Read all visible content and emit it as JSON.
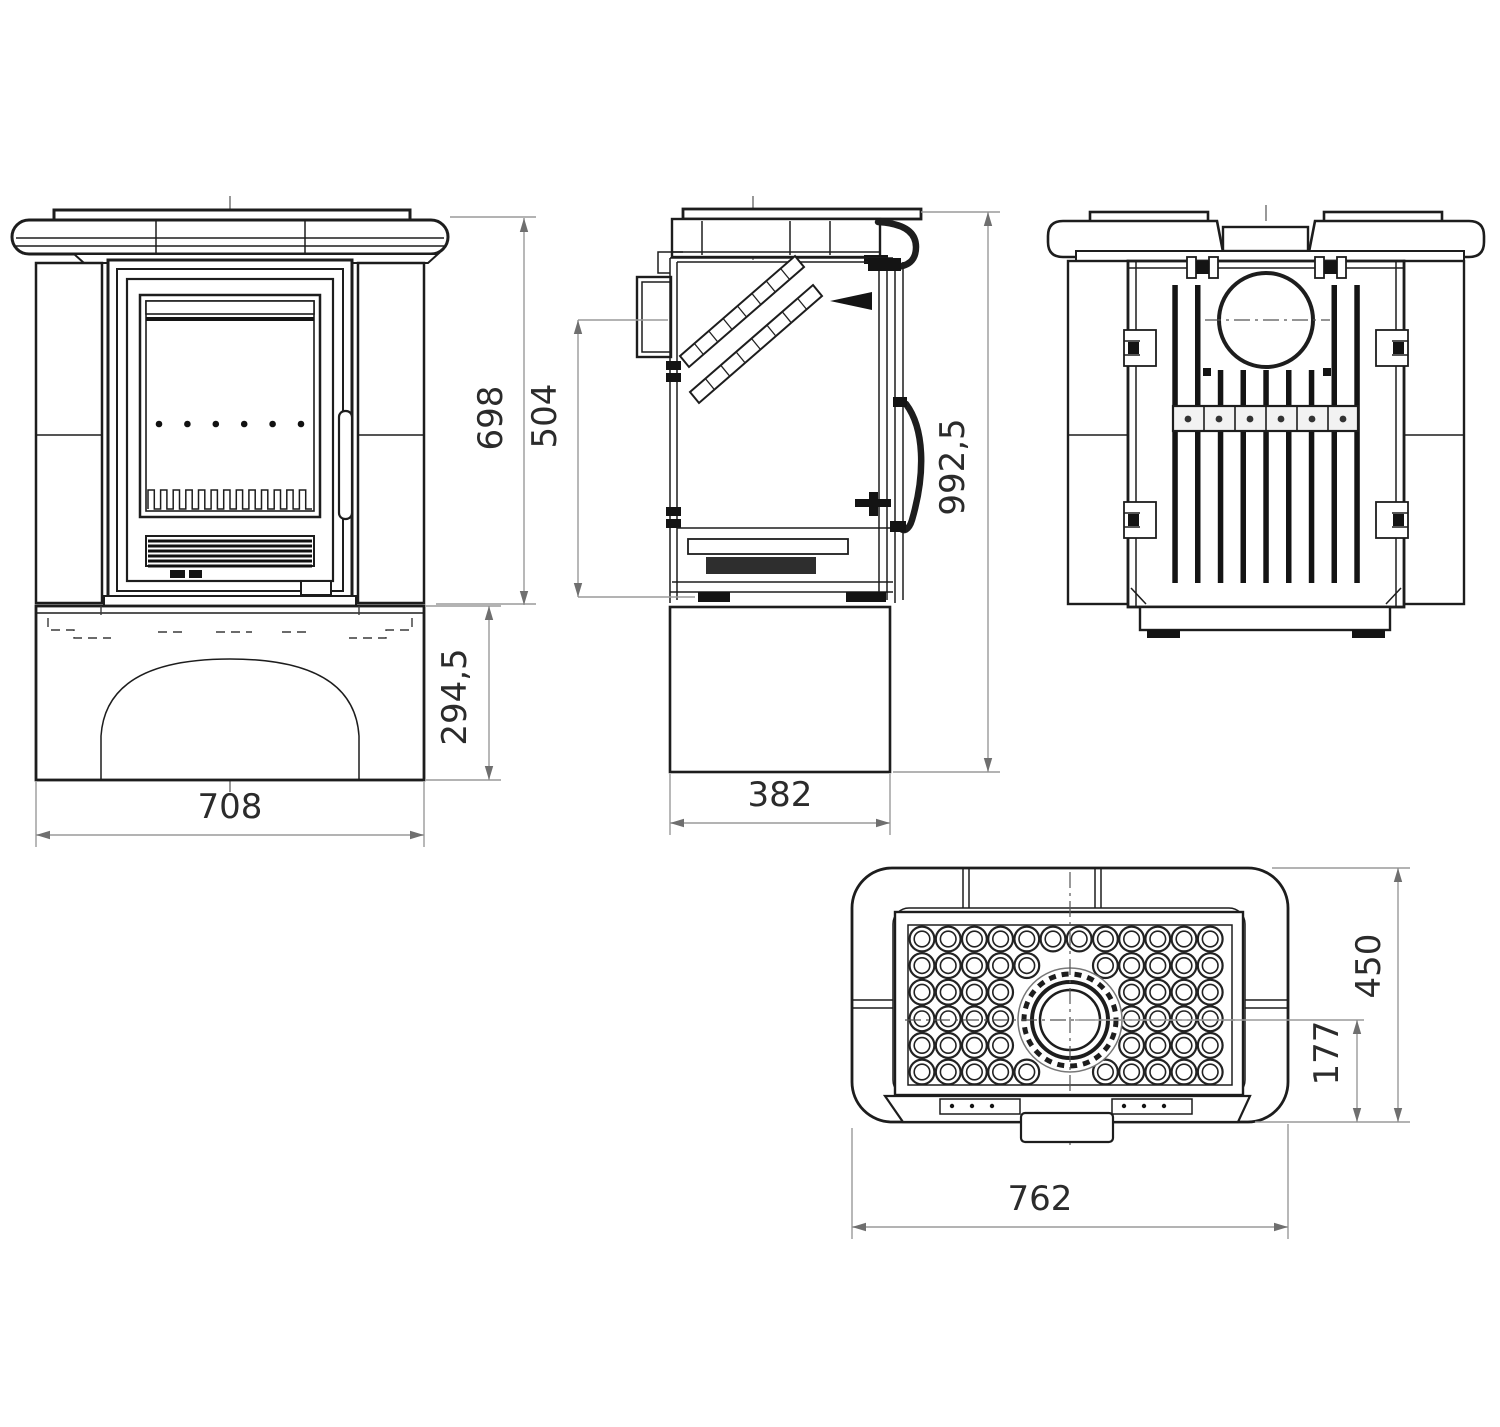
{
  "dims": {
    "front_height": "698",
    "firebox_height": "504",
    "overall_height": "992,5",
    "plinth_height": "294,5",
    "front_width": "708",
    "depth": "382",
    "top_depth": "450",
    "flue_to_front": "177",
    "top_width": "762"
  },
  "colors": {
    "background": "#ffffff",
    "line": "#1d1d1d",
    "dimension_line": "#9a9a9a",
    "dimension_text": "#2b2b2b",
    "dark_fill": "#141414"
  },
  "counts": {
    "hotplate_grid_cols": 12,
    "hotplate_grid_rows": 6,
    "rear_slats": 9,
    "glass_dots": 6,
    "zigzag_teeth": 13,
    "grille_lines": 6,
    "bracket_screws": 6
  }
}
